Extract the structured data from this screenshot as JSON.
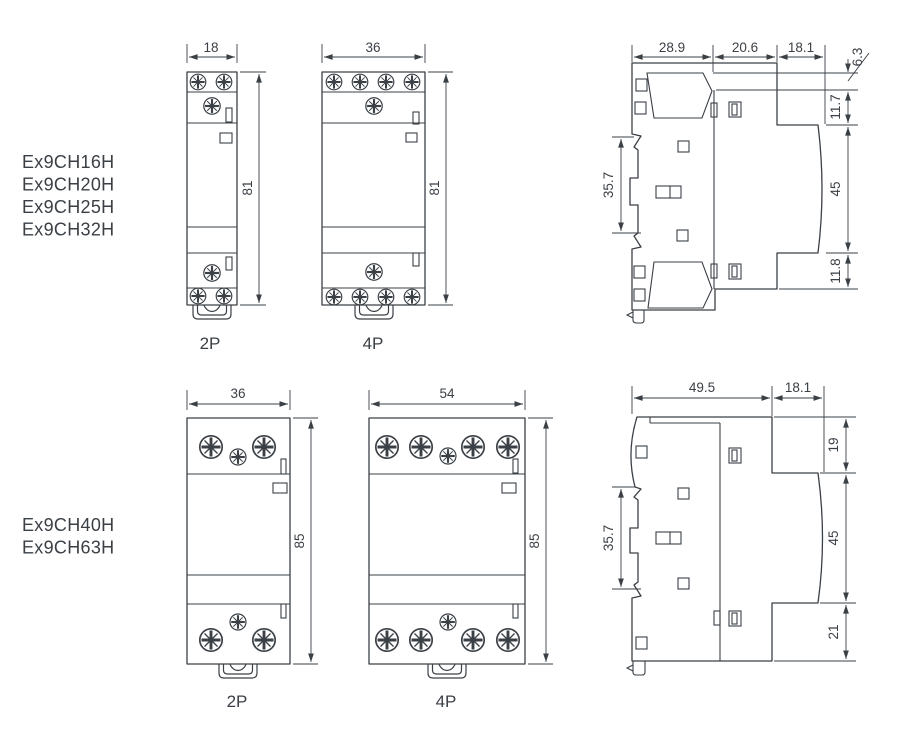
{
  "page": {
    "background": "#ffffff",
    "line_color": "#3b4046",
    "text_color": "#3b4046"
  },
  "top_row": {
    "models": [
      "Ex9CH16H",
      "Ex9CH20H",
      "Ex9CH25H",
      "Ex9CH32H"
    ],
    "front_2p": {
      "width_dim": "18",
      "height_dim": "81",
      "caption": "2P"
    },
    "front_4p": {
      "width_dim": "36",
      "height_dim": "81",
      "caption": "4P"
    },
    "side": {
      "depth_back": "28.9",
      "depth_mid": "20.6",
      "depth_front": "18.1",
      "top_step": "6.3",
      "front_top": "11.7",
      "front_mid": "45",
      "front_bottom": "11.8",
      "din_rail": "35.7"
    }
  },
  "bottom_row": {
    "models": [
      "Ex9CH40H",
      "Ex9CH63H"
    ],
    "front_2p": {
      "width_dim": "36",
      "height_dim": "85",
      "caption": "2P"
    },
    "front_4p": {
      "width_dim": "54",
      "height_dim": "85",
      "caption": "4P"
    },
    "side": {
      "depth_back": "49.5",
      "depth_front": "18.1",
      "front_top": "19",
      "front_mid": "45",
      "front_bottom": "21",
      "din_rail": "35.7"
    }
  }
}
